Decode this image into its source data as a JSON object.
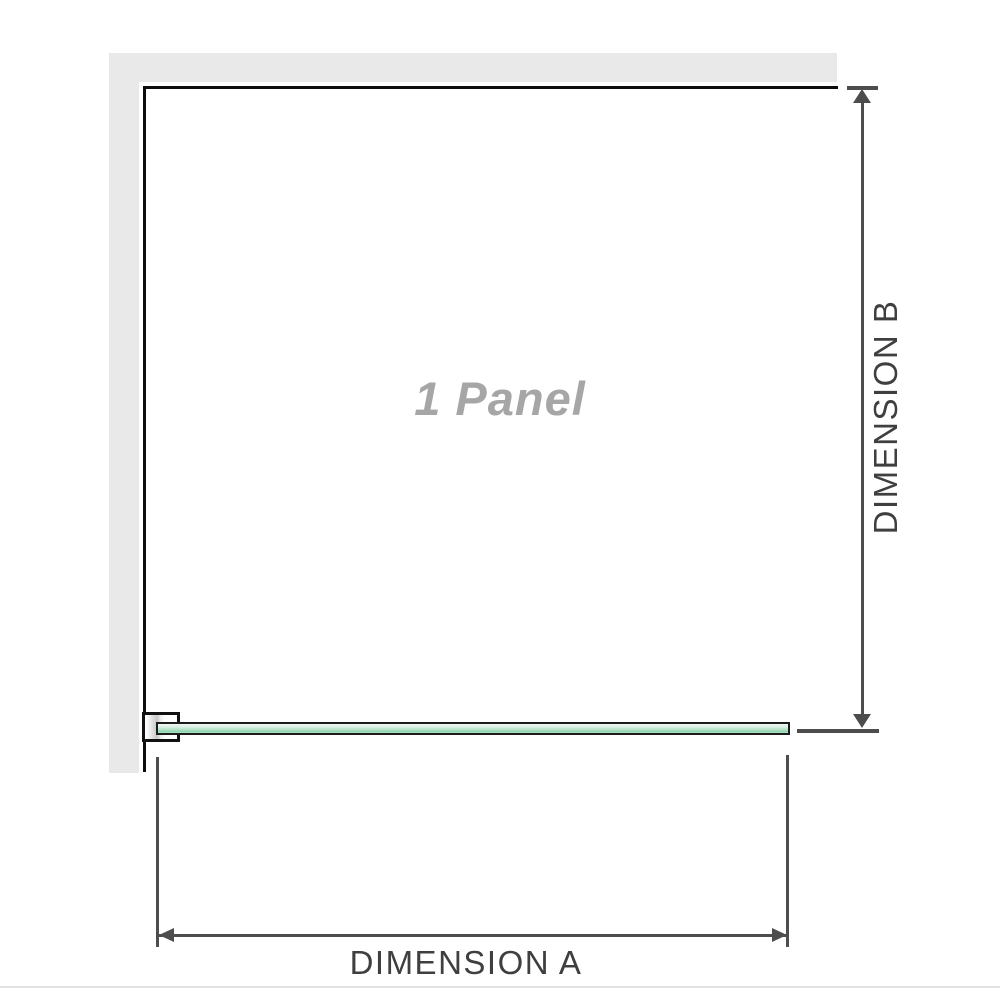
{
  "diagram": {
    "title": "1 Panel",
    "dimension_a_label": "DIMENSION A",
    "dimension_b_label": "DIMENSION B"
  },
  "icons": {
    "dimension_b_arrows": [
      "arrow-up-icon",
      "arrow-down-icon"
    ],
    "dimension_a_arrows": [
      "arrow-left-icon",
      "arrow-right-icon"
    ]
  },
  "colors": {
    "wall": "#e9e9e9",
    "outline": "#0d0d0d",
    "dimension": "#4d4d4d",
    "glass_border": "#1c1c1c",
    "glass_fill_light": "#d9efe2",
    "glass_fill_dark": "#8fd3ab",
    "label_text": "#3f3f3f",
    "watermark_text": "#a6a6a6",
    "divider": "#e2e2e2"
  }
}
